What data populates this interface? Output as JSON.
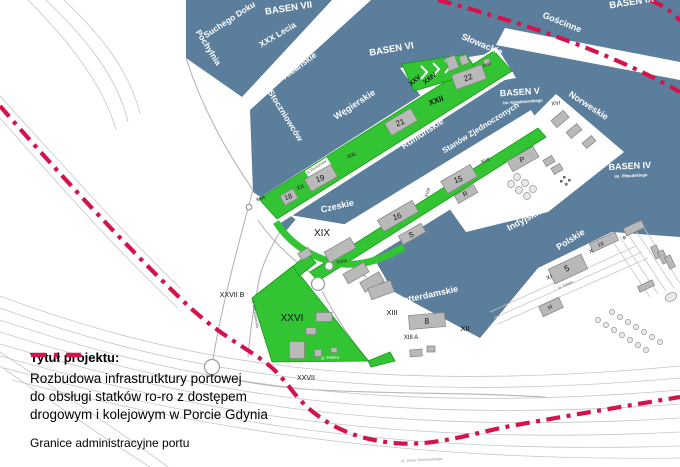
{
  "map_title": "Mapa Portu Gdynia",
  "colors": {
    "water": "#5b7e9c",
    "green": "#33c433",
    "green_dark": "#129a12",
    "red": "#d5134a",
    "building": "#b9b9b9",
    "building_stroke": "#828282",
    "rail": "#c6c6c6",
    "road": "#b4b4b4"
  },
  "title_block": {
    "heading": "Tytuł projektu:",
    "lines": [
      "Rozbudowa infrastrutktury portowej",
      "do obsługi statków ro-ro z dostępem",
      "drogowym i kolejowym w Porcie Gdynia"
    ]
  },
  "legend": {
    "label": "Granice administracyjne portu"
  },
  "labels": [
    {
      "name": "basen-vii",
      "text": "BASEN VII",
      "x": 289,
      "y": 11,
      "rot": -9,
      "size": 9.5,
      "color": "#ffffff",
      "weight": 700
    },
    {
      "name": "basen-ix",
      "text": "BASEN IX",
      "x": 632,
      "y": 5,
      "rot": -9,
      "size": 9.5,
      "color": "#ffffff",
      "weight": 700
    },
    {
      "name": "basen-vi",
      "text": "BASEN VI",
      "x": 392,
      "y": 52,
      "rot": -10,
      "size": 9.5,
      "color": "#ffffff",
      "weight": 700
    },
    {
      "name": "basen-v",
      "text": "BASEN V",
      "x": 520,
      "y": 95,
      "rot": -4,
      "size": 9,
      "color": "#ffffff",
      "weight": 700
    },
    {
      "name": "basen-v-sub",
      "text": "im. Kwiatkowskiego",
      "x": 523,
      "y": 103,
      "rot": -4,
      "size": 4.2,
      "color": "#ffffff",
      "weight": 700
    },
    {
      "name": "basen-iv",
      "text": "BASEN IV",
      "x": 630,
      "y": 169,
      "rot": -3,
      "size": 9,
      "color": "#ffffff",
      "weight": 700
    },
    {
      "name": "basen-iv-sub",
      "text": "im. Piłsudskiego",
      "x": 631,
      "y": 177,
      "rot": -3,
      "size": 4.2,
      "color": "#ffffff",
      "weight": 700
    },
    {
      "name": "quay-suchego-doku",
      "text": "Suchego Doku",
      "x": 231,
      "y": 22,
      "rot": -33,
      "size": 8.5,
      "color": "#ffffff",
      "weight": 700
    },
    {
      "name": "quay-pochylnia",
      "text": "Pochylnia",
      "x": 206,
      "y": 49,
      "rot": 58,
      "size": 8.5,
      "color": "#ffffff",
      "weight": 700
    },
    {
      "name": "quay-xxx-lecia",
      "text": "XXX Lecia",
      "x": 279,
      "y": 37,
      "rot": -31,
      "size": 8.5,
      "color": "#ffffff",
      "weight": 700
    },
    {
      "name": "quay-dunskie",
      "text": "Duńskie",
      "x": 357,
      "y": 5,
      "rot": -20,
      "size": 8.5,
      "color": "#ffffff",
      "weight": 700
    },
    {
      "name": "quay-albanskie",
      "text": "Albańskie",
      "x": 301,
      "y": 68,
      "rot": -36,
      "size": 8.5,
      "color": "#ffffff",
      "weight": 700
    },
    {
      "name": "quay-stoczniowcow",
      "text": "Stoczniowców",
      "x": 283,
      "y": 117,
      "rot": 58,
      "size": 8.5,
      "color": "#ffffff",
      "weight": 700
    },
    {
      "name": "quay-wegierskie",
      "text": "Węgierskie",
      "x": 356,
      "y": 107,
      "rot": -33,
      "size": 9,
      "color": "#ffffff",
      "weight": 700
    },
    {
      "name": "quay-slowackie",
      "text": "Słowackie",
      "x": 481,
      "y": 47,
      "rot": 22,
      "size": 9,
      "color": "#ffffff",
      "weight": 700
    },
    {
      "name": "quay-goscinne",
      "text": "Gościnne",
      "x": 561,
      "y": 25,
      "rot": 22,
      "size": 9,
      "color": "#ffffff",
      "weight": 700
    },
    {
      "name": "quay-norweskie",
      "text": "Norweskie",
      "x": 587,
      "y": 108,
      "rot": 33,
      "size": 9,
      "color": "#ffffff",
      "weight": 700
    },
    {
      "name": "quay-rumunskie",
      "text": "Rumuńskie",
      "x": 424,
      "y": 136,
      "rot": -33,
      "size": 9,
      "color": "#ffffff",
      "weight": 700
    },
    {
      "name": "quay-stanow-zjednoczonych",
      "text": "Stanów Zjednoczonych",
      "x": 482,
      "y": 130,
      "rot": -32,
      "size": 8,
      "color": "#ffffff",
      "weight": 700
    },
    {
      "name": "quay-czeskie",
      "text": "Czeskie",
      "x": 338,
      "y": 209,
      "rot": -13,
      "size": 9,
      "color": "#ffffff",
      "weight": 700
    },
    {
      "name": "quay-indyjskie",
      "text": "Indyjskie",
      "x": 526,
      "y": 222,
      "rot": -28,
      "size": 9,
      "color": "#ffffff",
      "weight": 700
    },
    {
      "name": "quay-polskie",
      "text": "Polskie",
      "x": 572,
      "y": 242,
      "rot": -32,
      "size": 9,
      "color": "#ffffff",
      "weight": 700
    },
    {
      "name": "quay-rotterdamskie",
      "text": "Rotterdamskie",
      "x": 428,
      "y": 298,
      "rot": -12,
      "size": 9,
      "color": "#ffffff",
      "weight": 700
    },
    {
      "name": "street-ul-polska",
      "text": "ul. Polska",
      "x": 330,
      "y": 359,
      "rot": -4,
      "size": 4.2,
      "color": "#ffffff",
      "weight": 400
    },
    {
      "name": "area-xxv",
      "text": "XXV",
      "x": 416,
      "y": 82,
      "rot": -39,
      "size": 6.5,
      "color": "#111111",
      "weight": 700
    },
    {
      "name": "area-xxiv",
      "text": "XXIV",
      "x": 431,
      "y": 80,
      "rot": -39,
      "size": 6.5,
      "color": "#111111",
      "weight": 700
    },
    {
      "name": "area-xxiii",
      "text": "XXIII",
      "x": 487,
      "y": 66,
      "rot": -20,
      "size": 4,
      "color": "#111111",
      "weight": 400
    },
    {
      "name": "area-xxii",
      "text": "XXII",
      "x": 437,
      "y": 103,
      "rot": -20,
      "size": 8,
      "color": "#111111",
      "weight": 700
    },
    {
      "name": "building-22",
      "text": "22",
      "x": 469,
      "y": 80,
      "rot": -20,
      "size": 8,
      "color": "#111111",
      "weight": 400
    },
    {
      "name": "building-21",
      "text": "21",
      "x": 401,
      "y": 125,
      "rot": -20,
      "size": 8,
      "color": "#111111",
      "weight": 400
    },
    {
      "name": "area-xxi",
      "text": "XXI",
      "x": 352,
      "y": 157,
      "rot": -20,
      "size": 5.5,
      "color": "#111111",
      "weight": 400
    },
    {
      "name": "building-19",
      "text": "19",
      "x": 321,
      "y": 181,
      "rot": -20,
      "size": 8,
      "color": "#111111",
      "weight": 400
    },
    {
      "name": "area-xx",
      "text": "XX",
      "x": 301,
      "y": 189,
      "rot": -20,
      "size": 6,
      "color": "#111111",
      "weight": 400
    },
    {
      "name": "building-18",
      "text": "18",
      "x": 289,
      "y": 199,
      "rot": -20,
      "size": 7,
      "color": "#111111",
      "weight": 400
    },
    {
      "name": "area-xxa",
      "text": "XXA",
      "x": 261,
      "y": 200,
      "rot": -20,
      "size": 4.8,
      "color": "#111111",
      "weight": 400
    },
    {
      "name": "area-xix",
      "text": "XIX",
      "x": 322,
      "y": 236,
      "rot": 0,
      "size": 10,
      "color": "#111111",
      "weight": 400
    },
    {
      "name": "area-xixa",
      "text": "XIXA",
      "x": 342,
      "y": 263,
      "rot": -8,
      "size": 4.8,
      "color": "#111111",
      "weight": 400
    },
    {
      "name": "building-16",
      "text": "16",
      "x": 398,
      "y": 219,
      "rot": -20,
      "size": 8,
      "color": "#111111",
      "weight": 400
    },
    {
      "name": "building-s",
      "text": "S",
      "x": 412,
      "y": 237,
      "rot": -20,
      "size": 7.5,
      "color": "#111111",
      "weight": 400
    },
    {
      "name": "area-xviii",
      "text": "XVIII",
      "x": 429,
      "y": 193,
      "rot": -72,
      "size": 4.5,
      "color": "#111111",
      "weight": 400
    },
    {
      "name": "building-15",
      "text": "15",
      "x": 459,
      "y": 182,
      "rot": -20,
      "size": 8,
      "color": "#111111",
      "weight": 400
    },
    {
      "name": "area-xvii",
      "text": "XVII",
      "x": 486,
      "y": 162,
      "rot": -20,
      "size": 4.8,
      "color": "#111111",
      "weight": 400
    },
    {
      "name": "building-p",
      "text": "P",
      "x": 523,
      "y": 162,
      "rot": -20,
      "size": 7.5,
      "color": "#111111",
      "weight": 400
    },
    {
      "name": "building-r",
      "text": "R",
      "x": 466,
      "y": 196,
      "rot": -20,
      "size": 6.5,
      "color": "#111111",
      "weight": 400
    },
    {
      "name": "area-xvi",
      "text": "XVI",
      "x": 556,
      "y": 105,
      "rot": -8,
      "size": 5.5,
      "color": "#111111",
      "weight": 400
    },
    {
      "name": "area-xxvi",
      "text": "XXVI",
      "x": 292,
      "y": 321,
      "rot": 0,
      "size": 10,
      "color": "#111111",
      "weight": 400
    },
    {
      "name": "area-xxvii-b",
      "text": "XXVII B",
      "x": 232,
      "y": 297,
      "rot": 0,
      "size": 7,
      "color": "#111111",
      "weight": 400
    },
    {
      "name": "area-xxvii",
      "text": "XXVII",
      "x": 306,
      "y": 380,
      "rot": 0,
      "size": 7,
      "color": "#111111",
      "weight": 400
    },
    {
      "name": "area-xiii",
      "text": "XIII",
      "x": 392,
      "y": 315,
      "rot": 0,
      "size": 7.5,
      "color": "#111111",
      "weight": 400
    },
    {
      "name": "building-8",
      "text": "8",
      "x": 427,
      "y": 324,
      "rot": -4,
      "size": 8.5,
      "color": "#111111",
      "weight": 400
    },
    {
      "name": "area-xii",
      "text": "XII",
      "x": 465,
      "y": 331,
      "rot": 0,
      "size": 7.5,
      "color": "#111111",
      "weight": 400
    },
    {
      "name": "area-xiii-a",
      "text": "XIII A",
      "x": 411,
      "y": 339,
      "rot": 0,
      "size": 6,
      "color": "#111111",
      "weight": 400
    },
    {
      "name": "building-5",
      "text": "5",
      "x": 568,
      "y": 271,
      "rot": -25,
      "size": 8.5,
      "color": "#111111",
      "weight": 400
    },
    {
      "name": "berth-x",
      "text": "X",
      "x": 592,
      "y": 253,
      "rot": -25,
      "size": 6,
      "color": "#111111",
      "weight": 400
    },
    {
      "name": "berth-ix",
      "text": "IX",
      "x": 602,
      "y": 246,
      "rot": -25,
      "size": 6,
      "color": "#111111",
      "weight": 400
    },
    {
      "name": "berth-xi",
      "text": "XI",
      "x": 550,
      "y": 279,
      "rot": -25,
      "size": 6,
      "color": "#111111",
      "weight": 400
    },
    {
      "name": "berth-b",
      "text": "B",
      "x": 625,
      "y": 239,
      "rot": -25,
      "size": 4.5,
      "color": "#111111",
      "weight": 400
    },
    {
      "name": "building-h",
      "text": "H",
      "x": 551,
      "y": 309,
      "rot": -25,
      "size": 6,
      "color": "#111111",
      "weight": 400
    },
    {
      "name": "street-ul-rumunska",
      "text": "ul. Rumuńska",
      "x": 317,
      "y": 168,
      "rot": -33,
      "size": 3.8,
      "color": "#555555",
      "weight": 400
    },
    {
      "name": "street-ul-rotterdamska",
      "text": "ul. Rotterdamska",
      "x": 254,
      "y": 314,
      "rot": 80,
      "size": 3.8,
      "color": "#555555",
      "weight": 400
    },
    {
      "name": "street-ul-polska-pier",
      "text": "ul. Polska",
      "x": 566,
      "y": 286,
      "rot": -25,
      "size": 3.6,
      "color": "#555555",
      "weight": 400
    },
    {
      "name": "street-ul-janka-wisniewskiego",
      "text": "ul. Janka Wiśniewskiego",
      "x": 422,
      "y": 461,
      "rot": -3,
      "size": 3.8,
      "color": "#999999",
      "weight": 400
    }
  ]
}
